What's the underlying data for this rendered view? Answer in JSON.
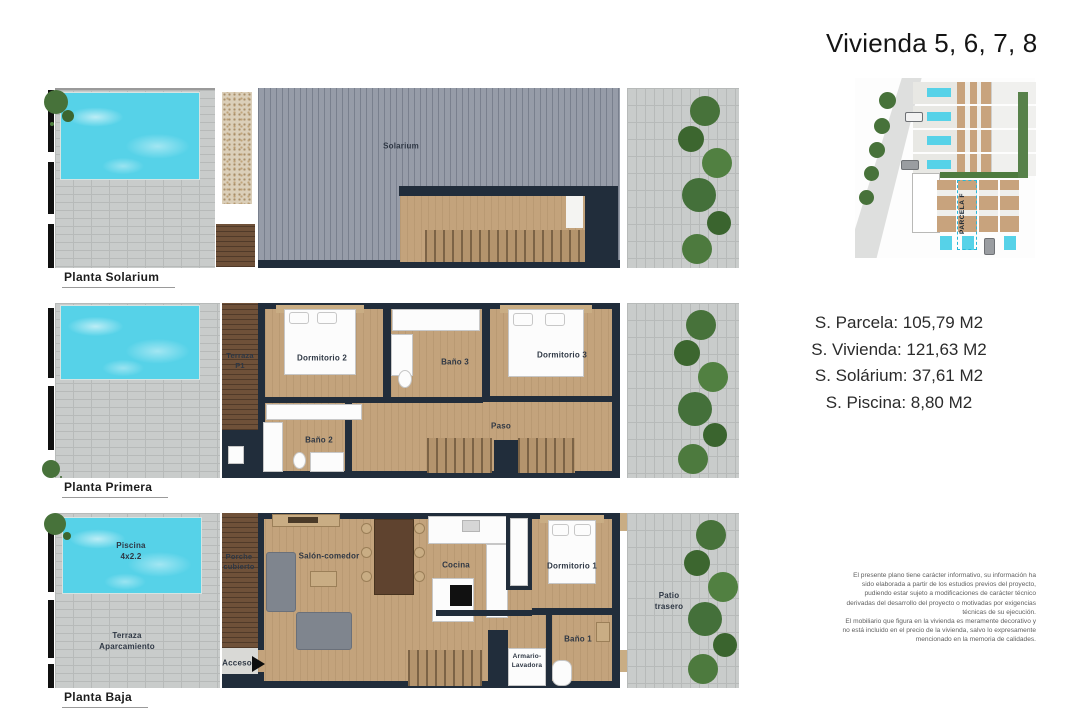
{
  "title": "Vivienda 5, 6, 7, 8",
  "site_plan": {
    "parcel_label": "PARCELA F"
  },
  "measurements": {
    "lines": [
      "S. Parcela: 105,79 M2",
      "S. Vivienda: 121,63 M2",
      "S. Solárium: 37,61 M2",
      "S. Piscina: 8,80 M2"
    ]
  },
  "disclaimer": {
    "p1": "El presente plano tiene carácter informativo, su información ha sido elaborada a partir de los estudios previos del proyecto, pudiendo estar sujeto a modificaciones de carácter técnico derivadas del desarrollo del proyecto o motivadas por exigencias técnicas de su ejecución.",
    "p2": "El mobiliario que figura en la vivienda es meramente decorativo y no está incluido en el precio de la vivienda, salvo lo expresamente mencionado en la memoria de calidades."
  },
  "plans": {
    "solarium": {
      "caption": "Planta Solarium",
      "rooms": {
        "solarium": "Solarium"
      }
    },
    "primera": {
      "caption": "Planta Primera",
      "rooms": {
        "terraza": "Terraza\nP1",
        "dormitorio2": "Dormitorio 2",
        "bano3": "Baño 3",
        "dormitorio3": "Dormitorio 3",
        "bano2": "Baño 2",
        "paso": "Paso"
      }
    },
    "baja": {
      "caption": "Planta Baja",
      "rooms": {
        "piscina": "Piscina\n4x2.2",
        "terraza_aparcamiento": "Terraza\nAparcamiento",
        "porche": "Porche\ncubierto",
        "acceso": "Acceso",
        "salon": "Salón-comedor",
        "cocina": "Cocina",
        "dormitorio1": "Dormitorio 1",
        "bano1": "Baño 1",
        "armario": "Armario-\nLavadora",
        "patio": "Patio\ntrasero"
      }
    }
  },
  "palette": {
    "pool": "#56d2e8",
    "wall": "#212d3b",
    "wood": "#c3a37c",
    "wood-dark": "#6f5139",
    "deck": "#969ca8",
    "paver": "#c9cccb",
    "paver-line": "#b7bab9",
    "green": "#47723a",
    "text-dark": "#1d1d1d",
    "label": "#2e3744",
    "muted": "#5f5f5f"
  }
}
